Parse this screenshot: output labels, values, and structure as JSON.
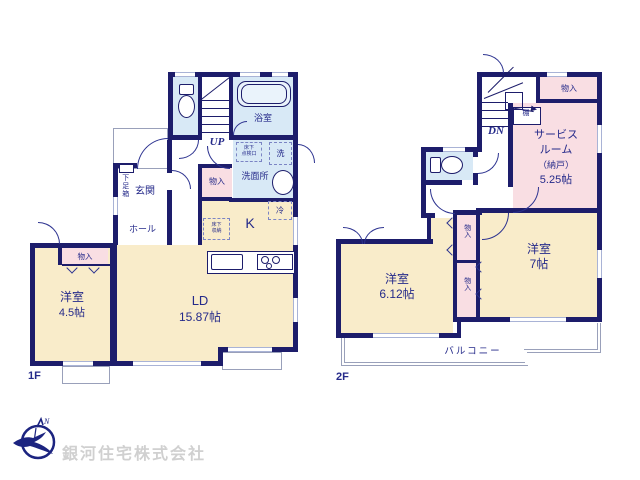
{
  "floor1": {
    "floor_label": "1F",
    "bath": "浴室",
    "stairs_up": "UP",
    "inspection_line1": "床下",
    "inspection_line2": "点検口",
    "washer": "洗",
    "washroom": "洗面所",
    "hall_closet": "物入",
    "fridge": "冷",
    "kitchen": "K",
    "underfloor_line1": "床下",
    "underfloor_line2": "収納",
    "entrance": "玄関",
    "shoe_box": "下足箱",
    "hall": "ホール",
    "bedroom1_name": "洋室",
    "bedroom1_size": "4.5帖",
    "bedroom1_closet": "物入",
    "living_name": "LD",
    "living_size": "15.87帖"
  },
  "floor2": {
    "floor_label": "2F",
    "stairs_down": "DN",
    "upper_closet": "物入",
    "shelf": "棚",
    "service_line1": "サービス",
    "service_line2": "ルーム",
    "service_line3": "（納戸）",
    "service_line4": "5.25帖",
    "closet_a": "物入",
    "closet_b": "物入",
    "bedroom2_name": "洋室",
    "bedroom2_size": "6.12帖",
    "bedroom3_name": "洋室",
    "bedroom3_size": "7帖",
    "balcony": "バルコニー"
  },
  "company": {
    "name": "銀河住宅株式会社"
  },
  "colors": {
    "wall": "#1d1d6b",
    "room": "#f9ecca",
    "wet_area": "#d8e9f6",
    "closet": "#f9dee3",
    "text": "#252a8a",
    "company_text": "#d0d0d0"
  }
}
